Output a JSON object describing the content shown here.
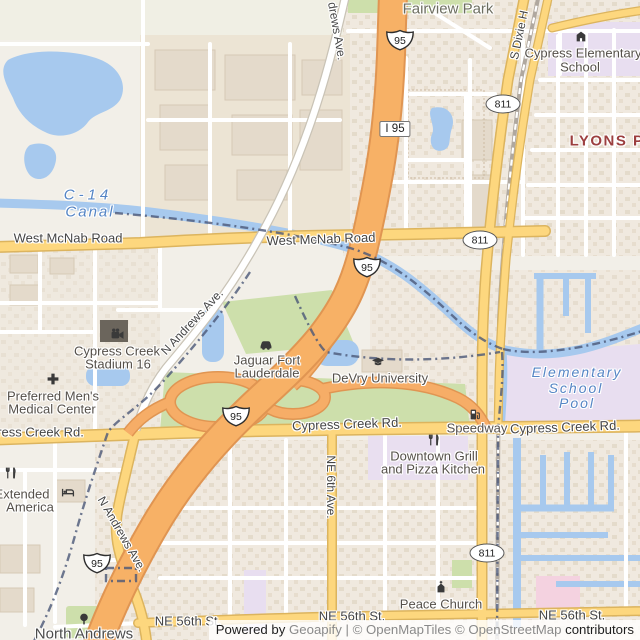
{
  "map": {
    "palette": {
      "background": "#f2efe8",
      "motorway": "#f7b166",
      "motorway_casing": "#e09552",
      "secondary_road": "#fdd77e",
      "secondary_casing": "#dcb45e",
      "minor_road": "#ffffff",
      "water": "#a7c9ee",
      "park_green": "#cddfab",
      "school_zone": "#e8def0",
      "hospital_pink": "#f4d2e0",
      "boundary": "#4b5878",
      "suburb_label": "#9c3f3f",
      "water_label": "#5585c5"
    },
    "labels": [
      {
        "text": "Fairview Park",
        "x": 448,
        "y": 9,
        "cls": "park",
        "size": 15
      },
      {
        "text": "drews Ave.",
        "x": 337,
        "y": 31,
        "cls": "street",
        "size": 12,
        "rot": 80
      },
      {
        "text": "S Dixie H",
        "x": 519,
        "y": 35,
        "cls": "street",
        "size": 12,
        "rot": -78
      },
      {
        "text": "Cypress Elementary",
        "x": 583,
        "y": 53,
        "cls": "poi",
        "size": 13
      },
      {
        "text": "School",
        "x": 580,
        "y": 67,
        "cls": "poi",
        "size": 13
      },
      {
        "text": "LYONS PARK",
        "x": 625,
        "y": 141,
        "cls": "suburb",
        "size": 15
      },
      {
        "text": "C-14",
        "x": 88,
        "y": 195,
        "cls": "water",
        "size": 15,
        "ls": 4
      },
      {
        "text": "Canal",
        "x": 90,
        "y": 212,
        "cls": "water",
        "size": 15,
        "ls": 2
      },
      {
        "text": "West McNab Road",
        "x": 68,
        "y": 238,
        "cls": "street",
        "size": 13
      },
      {
        "text": "West McNab Road",
        "x": 321,
        "y": 239,
        "cls": "street",
        "size": 13,
        "rot": -2
      },
      {
        "text": "N Andrews Ave.",
        "x": 192,
        "y": 322,
        "cls": "street",
        "size": 12,
        "rot": -47
      },
      {
        "text": "Cypress Creek",
        "x": 117,
        "y": 351,
        "cls": "poi",
        "size": 13
      },
      {
        "text": "Stadium 16",
        "x": 118,
        "y": 364,
        "cls": "poi",
        "size": 13
      },
      {
        "text": "Jaguar Fort",
        "x": 267,
        "y": 360,
        "cls": "poi",
        "size": 13
      },
      {
        "text": "Lauderdale",
        "x": 267,
        "y": 373,
        "cls": "poi",
        "size": 13
      },
      {
        "text": "Preferred Men's",
        "x": 53,
        "y": 396,
        "cls": "poi",
        "size": 13
      },
      {
        "text": "Medical Center",
        "x": 52,
        "y": 409,
        "cls": "poi",
        "size": 13
      },
      {
        "text": "DeVry University",
        "x": 380,
        "y": 378,
        "cls": "poi",
        "size": 13
      },
      {
        "text": "Elementary",
        "x": 577,
        "y": 372,
        "cls": "water",
        "size": 14,
        "ls": 2
      },
      {
        "text": "School",
        "x": 576,
        "y": 388,
        "cls": "water",
        "size": 14,
        "ls": 2
      },
      {
        "text": "Pool",
        "x": 577,
        "y": 403,
        "cls": "water",
        "size": 14,
        "ls": 2
      },
      {
        "text": "Cypress Creek Rd.",
        "x": 347,
        "y": 424,
        "cls": "street",
        "size": 13,
        "rot": -2
      },
      {
        "text": "Speedway",
        "x": 477,
        "y": 428,
        "cls": "poi",
        "size": 13
      },
      {
        "text": "Cypress Creek Rd.",
        "x": 565,
        "y": 427,
        "cls": "street",
        "size": 13,
        "rot": -2
      },
      {
        "text": "Cypress Creek Rd.",
        "x": 29,
        "y": 432,
        "cls": "street",
        "size": 13
      },
      {
        "text": "Downtown Grill",
        "x": 434,
        "y": 456,
        "cls": "poi",
        "size": 13
      },
      {
        "text": "and Pizza Kitchen",
        "x": 433,
        "y": 469,
        "cls": "poi",
        "size": 13
      },
      {
        "text": "NE 6th Ave.",
        "x": 331,
        "y": 487,
        "cls": "street",
        "size": 12,
        "rot": 90
      },
      {
        "text": "Extended",
        "x": 22,
        "y": 494,
        "cls": "poi",
        "size": 13
      },
      {
        "text": "America",
        "x": 30,
        "y": 507,
        "cls": "poi",
        "size": 13
      },
      {
        "text": "N Andrews Ave.",
        "x": 122,
        "y": 534,
        "cls": "street",
        "size": 12,
        "rot": 60
      },
      {
        "text": "NE 56th St.",
        "x": 188,
        "y": 621,
        "cls": "street",
        "size": 13
      },
      {
        "text": "NE 56th St.",
        "x": 352,
        "y": 616,
        "cls": "street",
        "size": 13
      },
      {
        "text": "Peace Church",
        "x": 441,
        "y": 604,
        "cls": "poi",
        "size": 13
      },
      {
        "text": "NE 56th St.",
        "x": 572,
        "y": 615,
        "cls": "street",
        "size": 13
      },
      {
        "text": "North Andrews",
        "x": 84,
        "y": 634,
        "cls": "place",
        "size": 15
      }
    ],
    "shields": [
      {
        "type": "interstate",
        "text": "95",
        "x": 400,
        "y": 40
      },
      {
        "type": "interstate",
        "text": "95",
        "x": 367,
        "y": 267
      },
      {
        "type": "interstate",
        "text": "95",
        "x": 236,
        "y": 416
      },
      {
        "type": "interstate",
        "text": "95",
        "x": 97,
        "y": 563
      },
      {
        "type": "box",
        "text": "I 95",
        "x": 395,
        "y": 129
      },
      {
        "type": "oval",
        "text": "811",
        "x": 503,
        "y": 104
      },
      {
        "type": "oval",
        "text": "811",
        "x": 480,
        "y": 240
      },
      {
        "type": "oval",
        "text": "811",
        "x": 487,
        "y": 553
      }
    ],
    "pois": [
      {
        "icon": "cinema-icon",
        "x": 117,
        "y": 334
      },
      {
        "icon": "medical-cross-icon",
        "x": 53,
        "y": 379
      },
      {
        "icon": "car-dealership-icon",
        "x": 266,
        "y": 344
      },
      {
        "icon": "graduation-cap-icon",
        "x": 378,
        "y": 362
      },
      {
        "icon": "fuel-pump-icon",
        "x": 475,
        "y": 414
      },
      {
        "icon": "restaurant-icon",
        "x": 434,
        "y": 440
      },
      {
        "icon": "restaurant-icon",
        "x": 11,
        "y": 473
      },
      {
        "icon": "lodging-icon",
        "x": 68,
        "y": 491
      },
      {
        "icon": "church-icon",
        "x": 441,
        "y": 587
      },
      {
        "icon": "tree-icon",
        "x": 84,
        "y": 619
      },
      {
        "icon": "school-icon",
        "x": 581,
        "y": 36
      }
    ]
  },
  "attribution": {
    "powered_by": "Powered by",
    "geoapify": "Geoapify",
    "separator": "|",
    "maptiles": "© OpenMapTiles",
    "osm": "© OpenStreetMap",
    "contributors": "contributors"
  }
}
